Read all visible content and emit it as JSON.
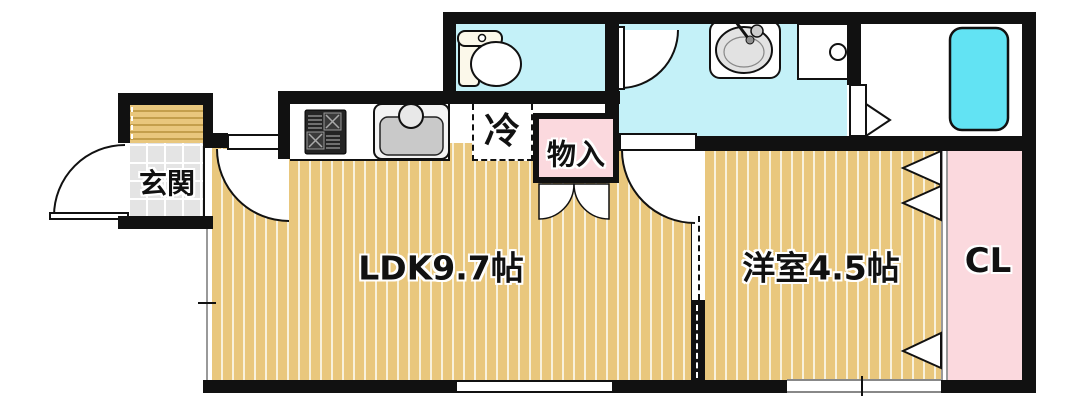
{
  "title": "apartment-floorplan",
  "rooms": {
    "entrance": {
      "label": "玄関"
    },
    "ldk": {
      "label": "LDK9.7帖"
    },
    "western_room": {
      "label": "洋室4.5帖"
    },
    "closet": {
      "label": "CL"
    },
    "refrigerator_space": {
      "label": "冷"
    },
    "storage": {
      "label": "物入"
    }
  },
  "colors": {
    "wall": "#111111",
    "floor_tan": "#e9c77d",
    "floor_stripe": "#f8f1dc",
    "wet_area": "#c4f1f8",
    "bathtub": "#62e3f3",
    "pink": "#fbd9de",
    "tile": "#e4e4e4",
    "porch_stripe": "#c49f4c"
  }
}
